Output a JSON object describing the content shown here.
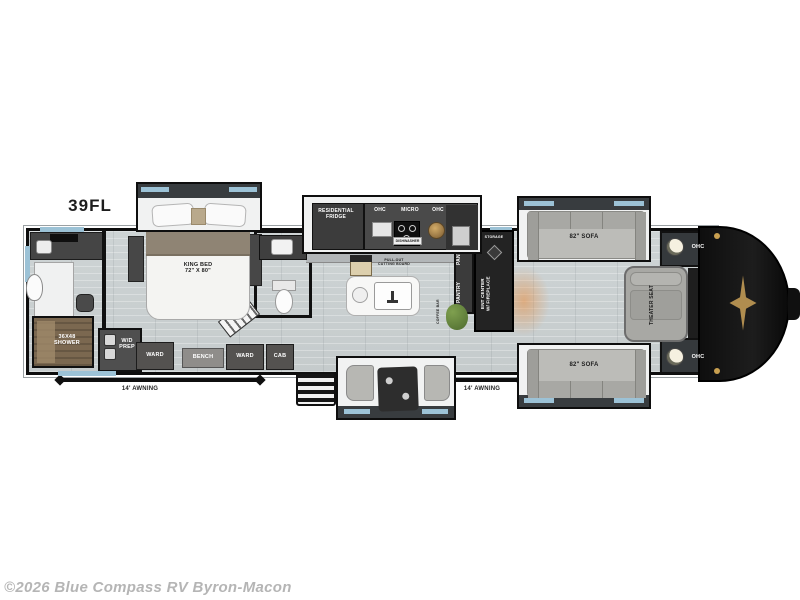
{
  "title": {
    "model": "39FL"
  },
  "watermark": "©2026 Blue Compass RV Byron-Macon",
  "labels": {
    "fridge": "RESIDENTIAL\nFRIDGE",
    "ohc_a": "OHC",
    "micro": "MICRO",
    "ohc_b": "OHC",
    "dishwasher": "DISHWASHER",
    "king_bed": "KING BED\n72\" X 80\"",
    "shower": "36X48\nSHOWER",
    "wd_prep": "W/D\nPREP",
    "ward_a": "WARD",
    "bench": "BENCH",
    "ward_b": "WARD",
    "cab": "CAB",
    "cutting_board": "PULL-OUT\nCUTTING BOARD",
    "coffee_bar": "COFFEE BAR",
    "pantry_a": "PANTRY",
    "pantry_b": "PANTRY",
    "storage": "STORAGE",
    "ent_center": "ENT CENTER\nW/ FIREPLACE",
    "sofa_top": "82\" SOFA",
    "sofa_bottom": "82\" SOFA",
    "theater_seat": "THEATER SEAT",
    "ohc_rear_top": "OHC",
    "ohc_rear_bottom": "OHC",
    "awning_left": "14' AWNING",
    "awning_right": "14' AWNING"
  },
  "colors": {
    "window_accent": "#9cc2d6",
    "cabinet_dark": "#4a4a4a",
    "rear_cap": "#121212",
    "emblem_gold": "#b08d4f",
    "fireplace_glow": "#e98c3c",
    "floor": "#cbd1d2",
    "sofa": "#b9b9b5",
    "watermark_gray": "#b5b5b5"
  }
}
